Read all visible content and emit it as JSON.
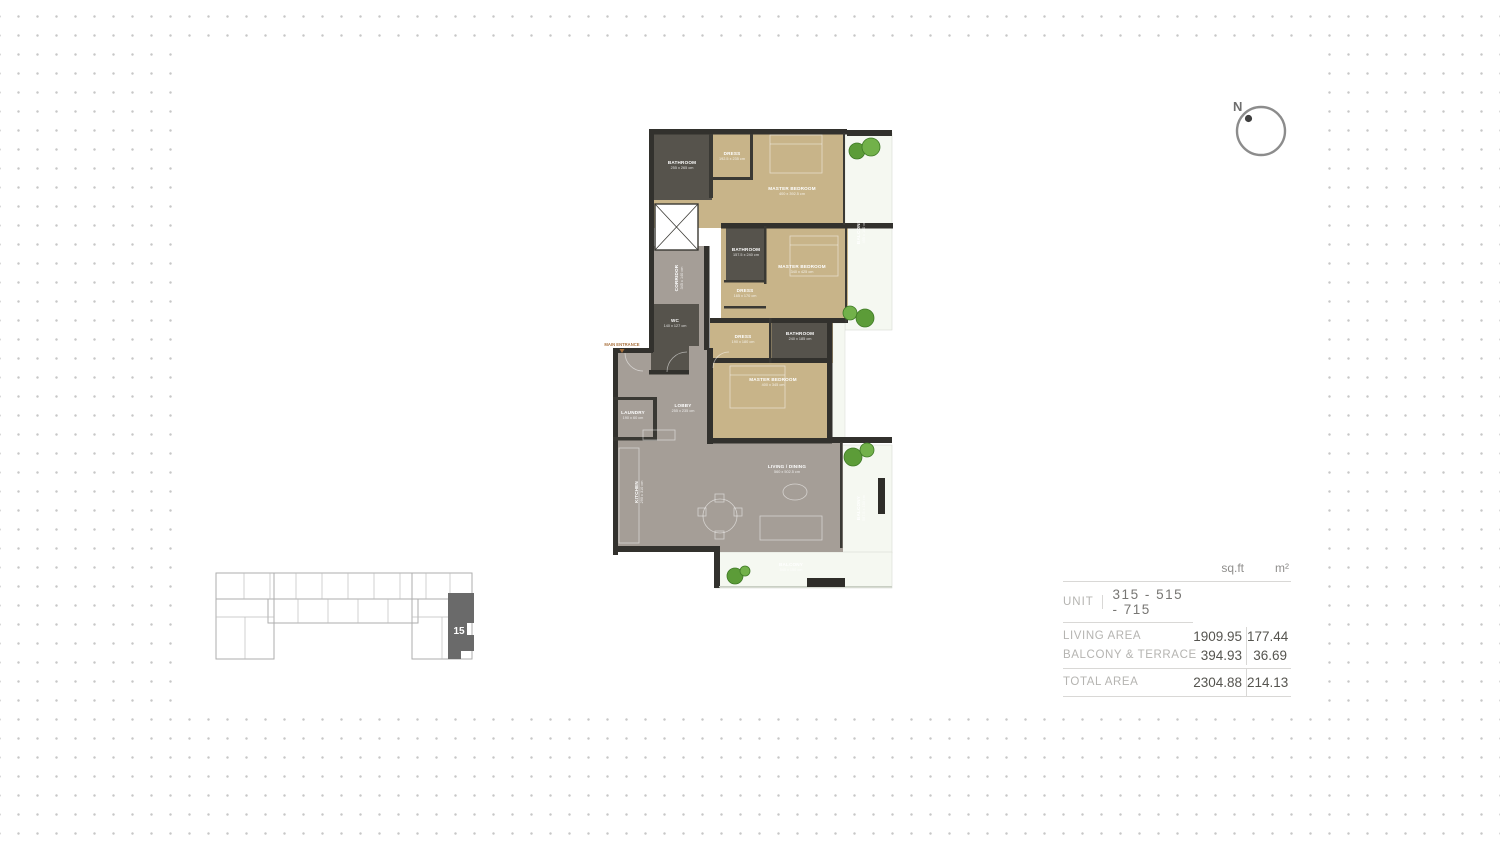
{
  "compass": {
    "north_label": "N"
  },
  "floor_plan": {
    "main_entrance": "MAIN ENTRANCE",
    "rooms": {
      "bathroom_1": {
        "name": "BATHROOM",
        "dims": "255 x 265 cm"
      },
      "dress_1": {
        "name": "DRESS",
        "dims": "192.5 x 235 cm"
      },
      "master_bedroom_1": {
        "name": "MASTER BEDROOM",
        "dims": "400 x 392.5 cm"
      },
      "balcony_right": {
        "name": "BALCONY",
        "dims": "495 x 180 cm"
      },
      "bathroom_2": {
        "name": "BATHROOM",
        "dims": "157.5 x 240 cm"
      },
      "dress_2": {
        "name": "DRESS",
        "dims": "165 x 170 cm"
      },
      "master_bedroom_2": {
        "name": "MASTER BEDROOM",
        "dims": "340 x 425 cm"
      },
      "corridor": {
        "name": "CORRIDOR",
        "dims": "345 x 140 cm"
      },
      "wc": {
        "name": "WC",
        "dims": "140 x 127 cm"
      },
      "dress_3": {
        "name": "DRESS",
        "dims": "190 x 180 cm"
      },
      "bathroom_3": {
        "name": "BATHROOM",
        "dims": "240 x 185 cm"
      },
      "master_bedroom_3": {
        "name": "MASTER BEDROOM",
        "dims": "400 x 345 cm"
      },
      "lobby": {
        "name": "LOBBY",
        "dims": "255 x 235 cm"
      },
      "laundry": {
        "name": "LAUNDRY",
        "dims": "190 x 60 cm"
      },
      "kitchen": {
        "name": "KITCHEN",
        "dims": "290 x 310 cm"
      },
      "living_dining": {
        "name": "LIVING / DINING",
        "dims": "560 x 502.5 cm"
      },
      "balcony_bottom": {
        "name": "BALCONY",
        "dims": "545 x 150 cm"
      },
      "balcony_right_low": {
        "name": "BALCONY",
        "dims": "587.5 x 150 cm"
      }
    }
  },
  "key_plan": {
    "highlighted_unit": "15"
  },
  "area_table": {
    "headers": {
      "sqft": "sq.ft",
      "sqm": "m²"
    },
    "unit": {
      "label": "UNIT",
      "value": "315 - 515 - 715"
    },
    "rows": [
      {
        "label": "LIVING AREA",
        "sqft": "1909.95",
        "sqm": "177.44"
      },
      {
        "label": "BALCONY & TERRACE",
        "sqft": "394.93",
        "sqm": "36.69"
      }
    ],
    "total": {
      "label": "TOTAL AREA",
      "sqft": "2304.88",
      "sqm": "214.13"
    }
  },
  "colors": {
    "bedroom_fill": "#c8b489",
    "bathroom_fill": "#56534c",
    "living_fill": "#a59e97",
    "wall": "#32312d",
    "balcony_fill": "#f5f8f1",
    "plant_green": "#5c9c38",
    "entrance_accent": "#a9713d",
    "dot_grid": "#c7c7c7",
    "unit_highlight": "#6a6a6a"
  }
}
